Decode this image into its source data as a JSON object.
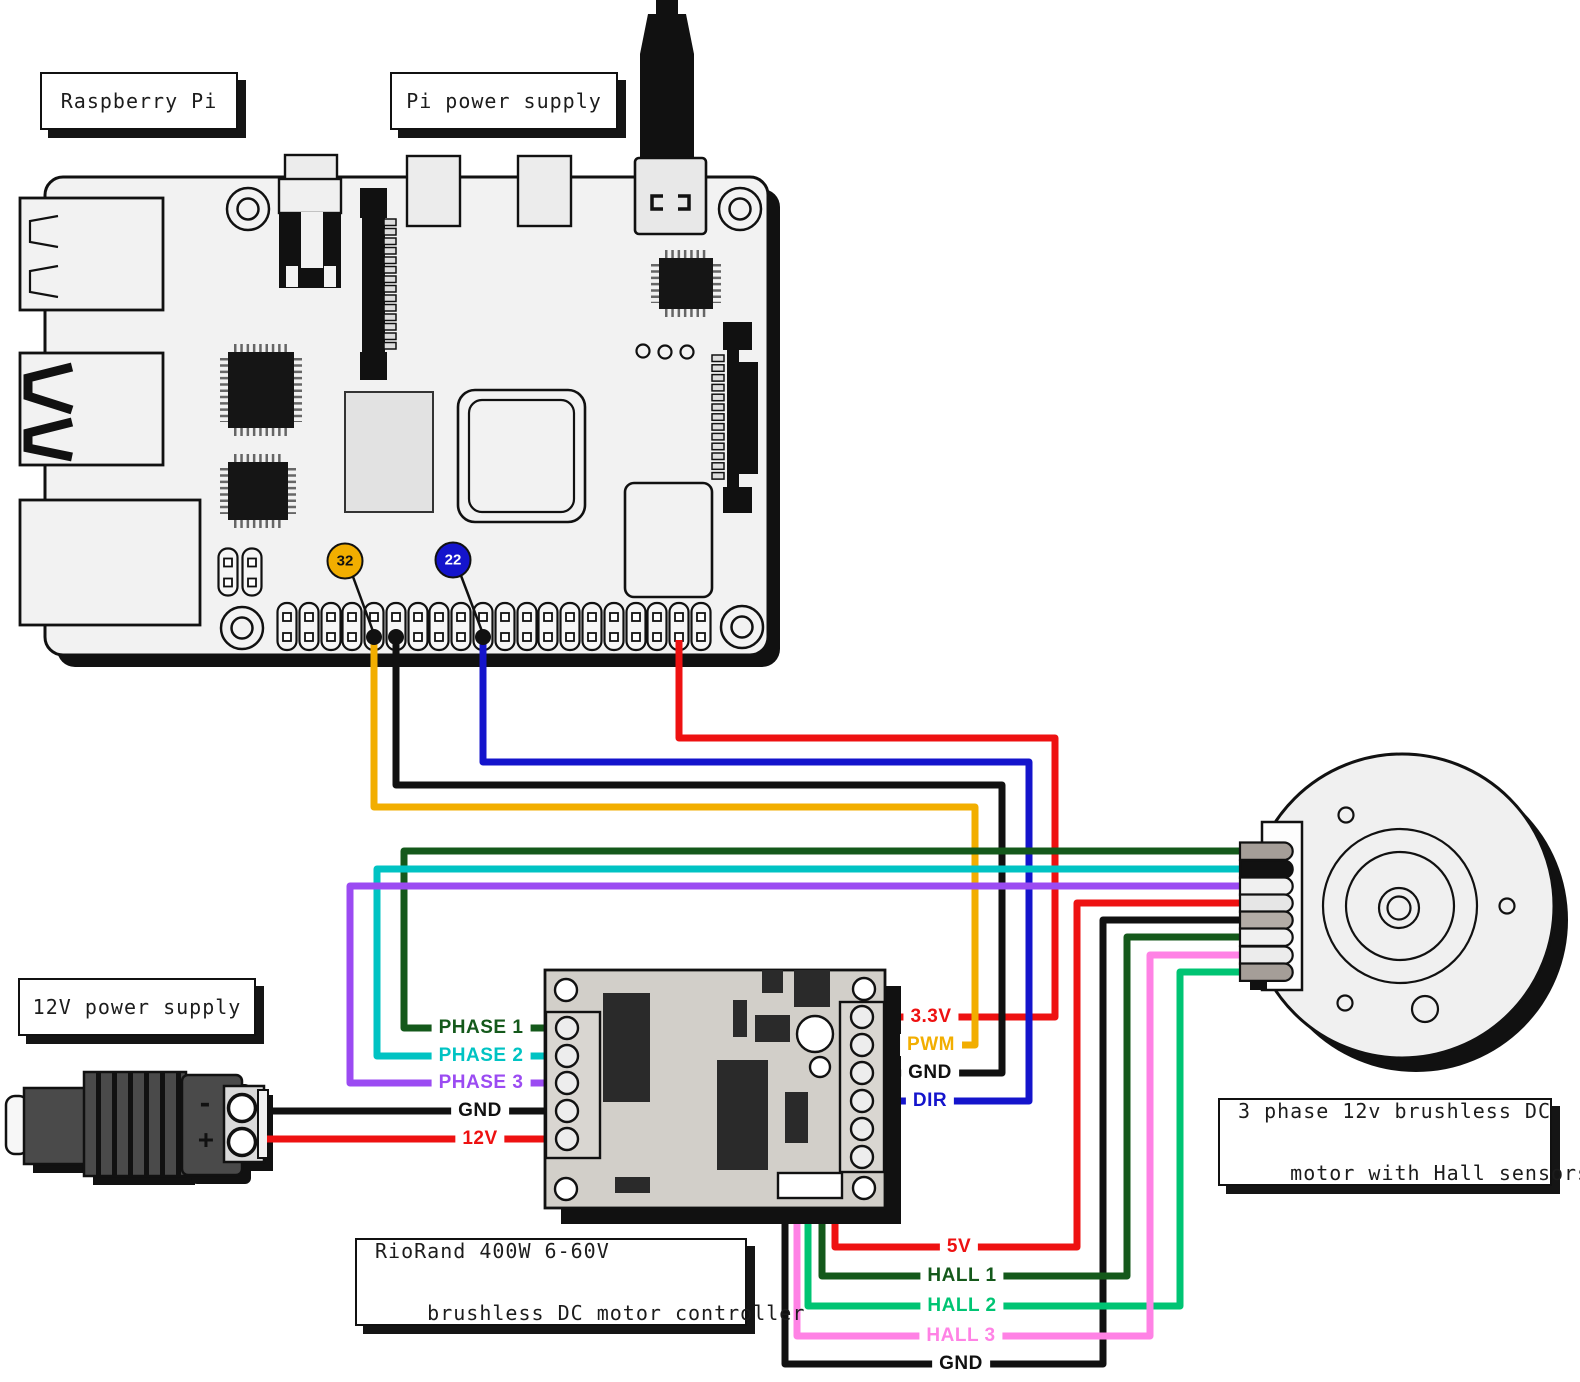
{
  "title_boxes": {
    "raspberry_pi": "Raspberry Pi",
    "pi_power_supply": "Pi power supply",
    "twelve_v_power_supply": "12V power supply",
    "controller_line1": "RioRand 400W 6-60V",
    "controller_line2": "brushless DC motor controller",
    "motor_line1": "3 phase 12v brushless DC",
    "motor_line2": "motor with Hall sensors"
  },
  "gpio_badges": {
    "pwm_pin": "32",
    "dir_pin": "22"
  },
  "power_terminals": {
    "negative": "-",
    "positive": "+"
  },
  "wire_labels": {
    "phase1": "PHASE 1",
    "phase2": "PHASE 2",
    "phase3": "PHASE 3",
    "gnd_left": "GND",
    "v12": "12V",
    "v33": "3.3V",
    "pwm": "PWM",
    "gnd_right": "GND",
    "dir": "DIR",
    "v5": "5V",
    "hall1": "HALL 1",
    "hall2": "HALL 2",
    "hall3": "HALL 3",
    "gnd_bottom": "GND"
  },
  "colors": {
    "orange": "#f2ae00",
    "blue": "#1414cc",
    "red": "#ee1111",
    "black": "#111111",
    "dark_green": "#14591b",
    "cyan": "#00c3c3",
    "purple": "#9b4bf2",
    "pink": "#ff82e5",
    "spring_green": "#00c473"
  }
}
